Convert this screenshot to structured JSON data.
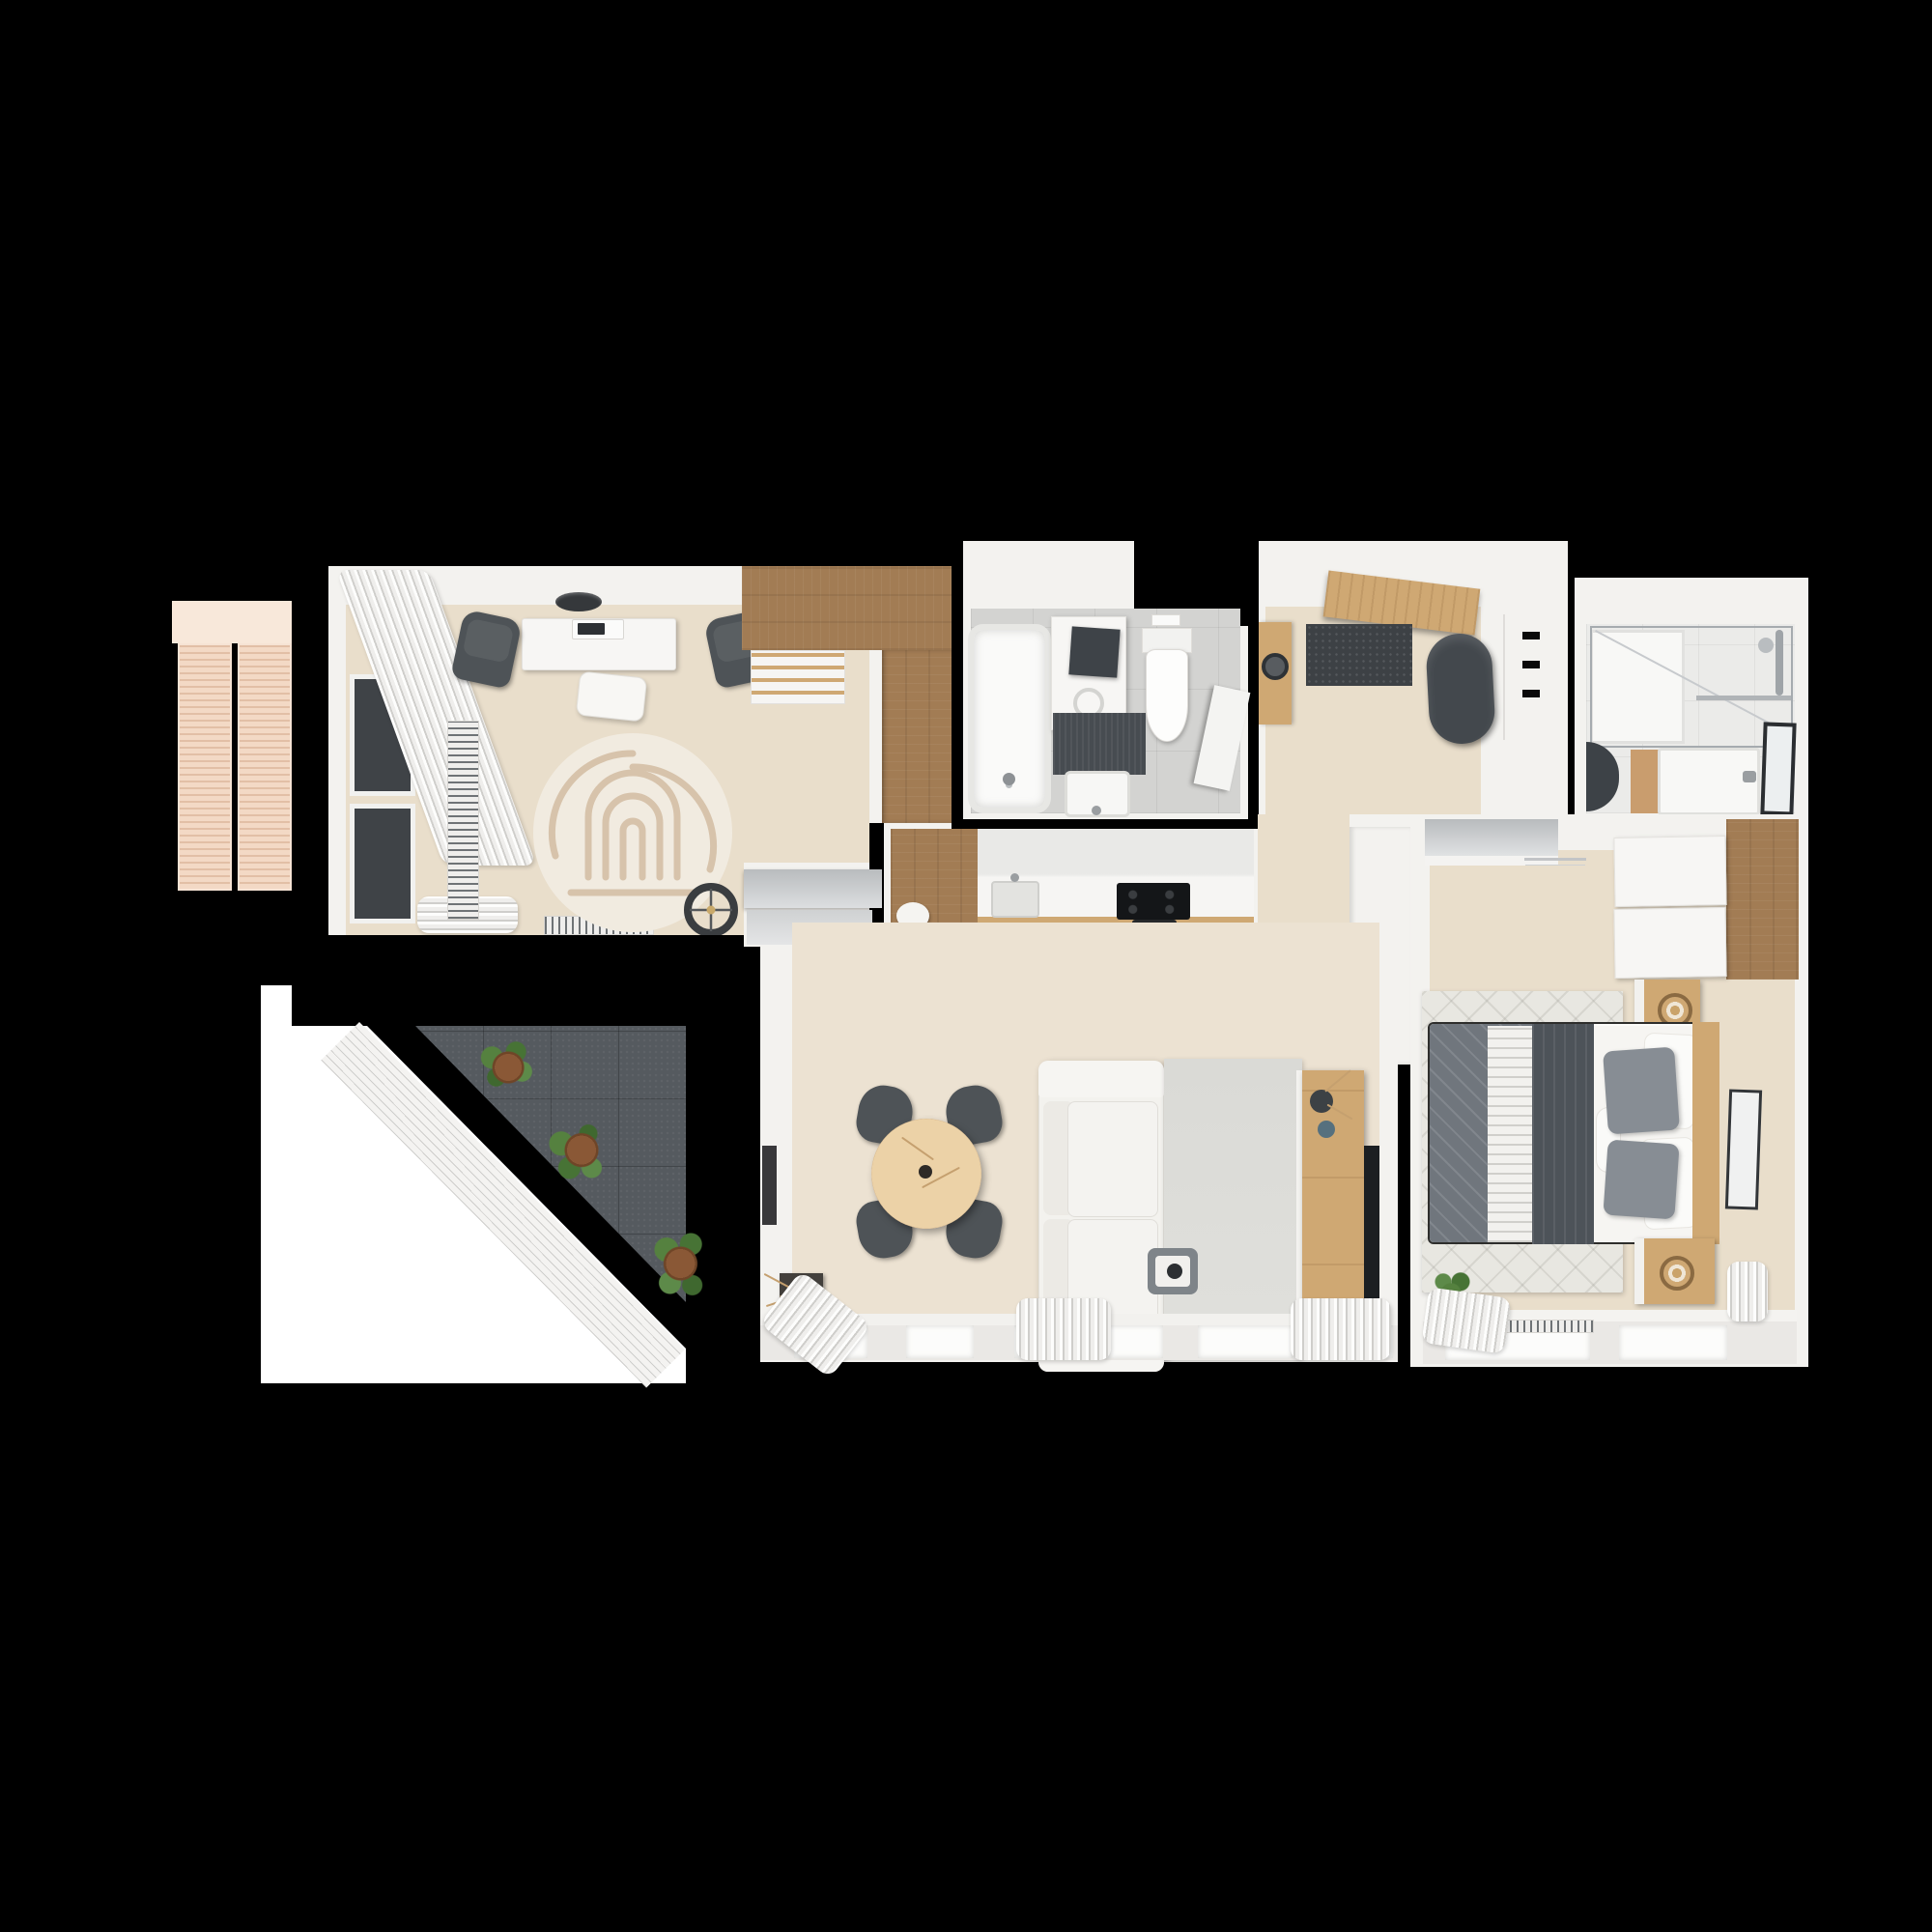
{
  "scene": {
    "type": "3d-floor-plan-top-down-render",
    "description": "Top-down 3D architectural render of a small apartment on a black background",
    "text_visible": false
  },
  "colors": {
    "bg": "#000000",
    "wall": "#f3f2ef",
    "floor-wood": "#e9decb",
    "floor-living": "#ece2d2",
    "floor-bath": "#d3d3d1",
    "floor-bath2": "#ebebe9",
    "wood-dark": "#a27c54",
    "oak": "#cfa873",
    "oak-light": "#ecd2a7",
    "gray-dark": "#45494e",
    "gray-chair": "#4e5357",
    "gray-mid": "#82888d",
    "sofa": "#f3f2ee",
    "rug-cream": "#f1ebe0",
    "rug-pattern": "#d7c3ab",
    "rug-gray": "#dcdcd8",
    "rug-bed": "#e8e7e1",
    "quilt-light": "#70767d",
    "quilt-dark": "#4d5359",
    "terrace-tile": "#555a5f",
    "balcony": "#f3d9c5",
    "glass": "#3f4347",
    "plant": "#4d7a3e",
    "curtain-line": "#cfcecb",
    "tv-black": "#1c1f22",
    "chrome": "#a6abaf"
  },
  "rooms": {
    "balcony": {
      "label": "Balcony (west, wood slat deck)",
      "items": [
        "slatted decking panels"
      ]
    },
    "office": {
      "label": "Home office",
      "items": [
        "white desk",
        "laptop",
        "two gray desk chairs",
        "ceiling lamp",
        "round maze-pattern rug",
        "floor cushion",
        "black floor lamp",
        "floor-to-ceiling windows",
        "curtains",
        "vertical radiator",
        "baseboard radiator",
        "L-shaped brown wardrobe",
        "open shelf unit",
        "sliding doors to living room"
      ]
    },
    "bathroom": {
      "label": "Main bathroom",
      "items": [
        "bathtub",
        "washing machine with counter",
        "laundry basket",
        "toilet",
        "flush plate",
        "dark bath mat",
        "washbasin",
        "open door"
      ]
    },
    "hallway": {
      "label": "Entry hallway",
      "items": [
        "open wooden entry door",
        "dark doormat",
        "oval gray pouf",
        "small wood console with bowl",
        "wall hooks"
      ]
    },
    "shower_room": {
      "label": "Shower room",
      "items": [
        "walk-in glass shower",
        "shower tray",
        "chrome shower set",
        "towel bar",
        "wood vanity with washbasin",
        "dark framed mirror",
        "dark half-round rug"
      ]
    },
    "bedroom": {
      "label": "Bedroom",
      "items": [
        "double bed with gray quilts",
        "white and gray pillows",
        "bolster",
        "wood headboard",
        "two oak nightstands with ring lamps",
        "white-and-oak wardrobe",
        "low gray console",
        "clothes rail",
        "patterned area rug",
        "leaning mirror",
        "potted plant",
        "window with radiator",
        "curtains"
      ]
    },
    "kitchen": {
      "label": "Kitchen",
      "items": [
        "white counter run",
        "sink",
        "induction cooktop",
        "oven handle",
        "brown tall cabinet",
        "oak plinth",
        "white stool"
      ]
    },
    "living_room": {
      "label": "Living room",
      "items": [
        "round oak dining table with vase",
        "four dark dining chairs",
        "white sofa",
        "light gray rug",
        "serving tray with cup",
        "oak TV sideboard",
        "two dark vases with branches",
        "wall-mounted TV",
        "framed artwork",
        "dark decor box with dried branches",
        "window wall with curtains"
      ]
    },
    "terrace": {
      "label": "Terrace",
      "items": [
        "dark gray tile paving",
        "white slatted railing",
        "three potted plants",
        "white pavement apron"
      ]
    }
  }
}
